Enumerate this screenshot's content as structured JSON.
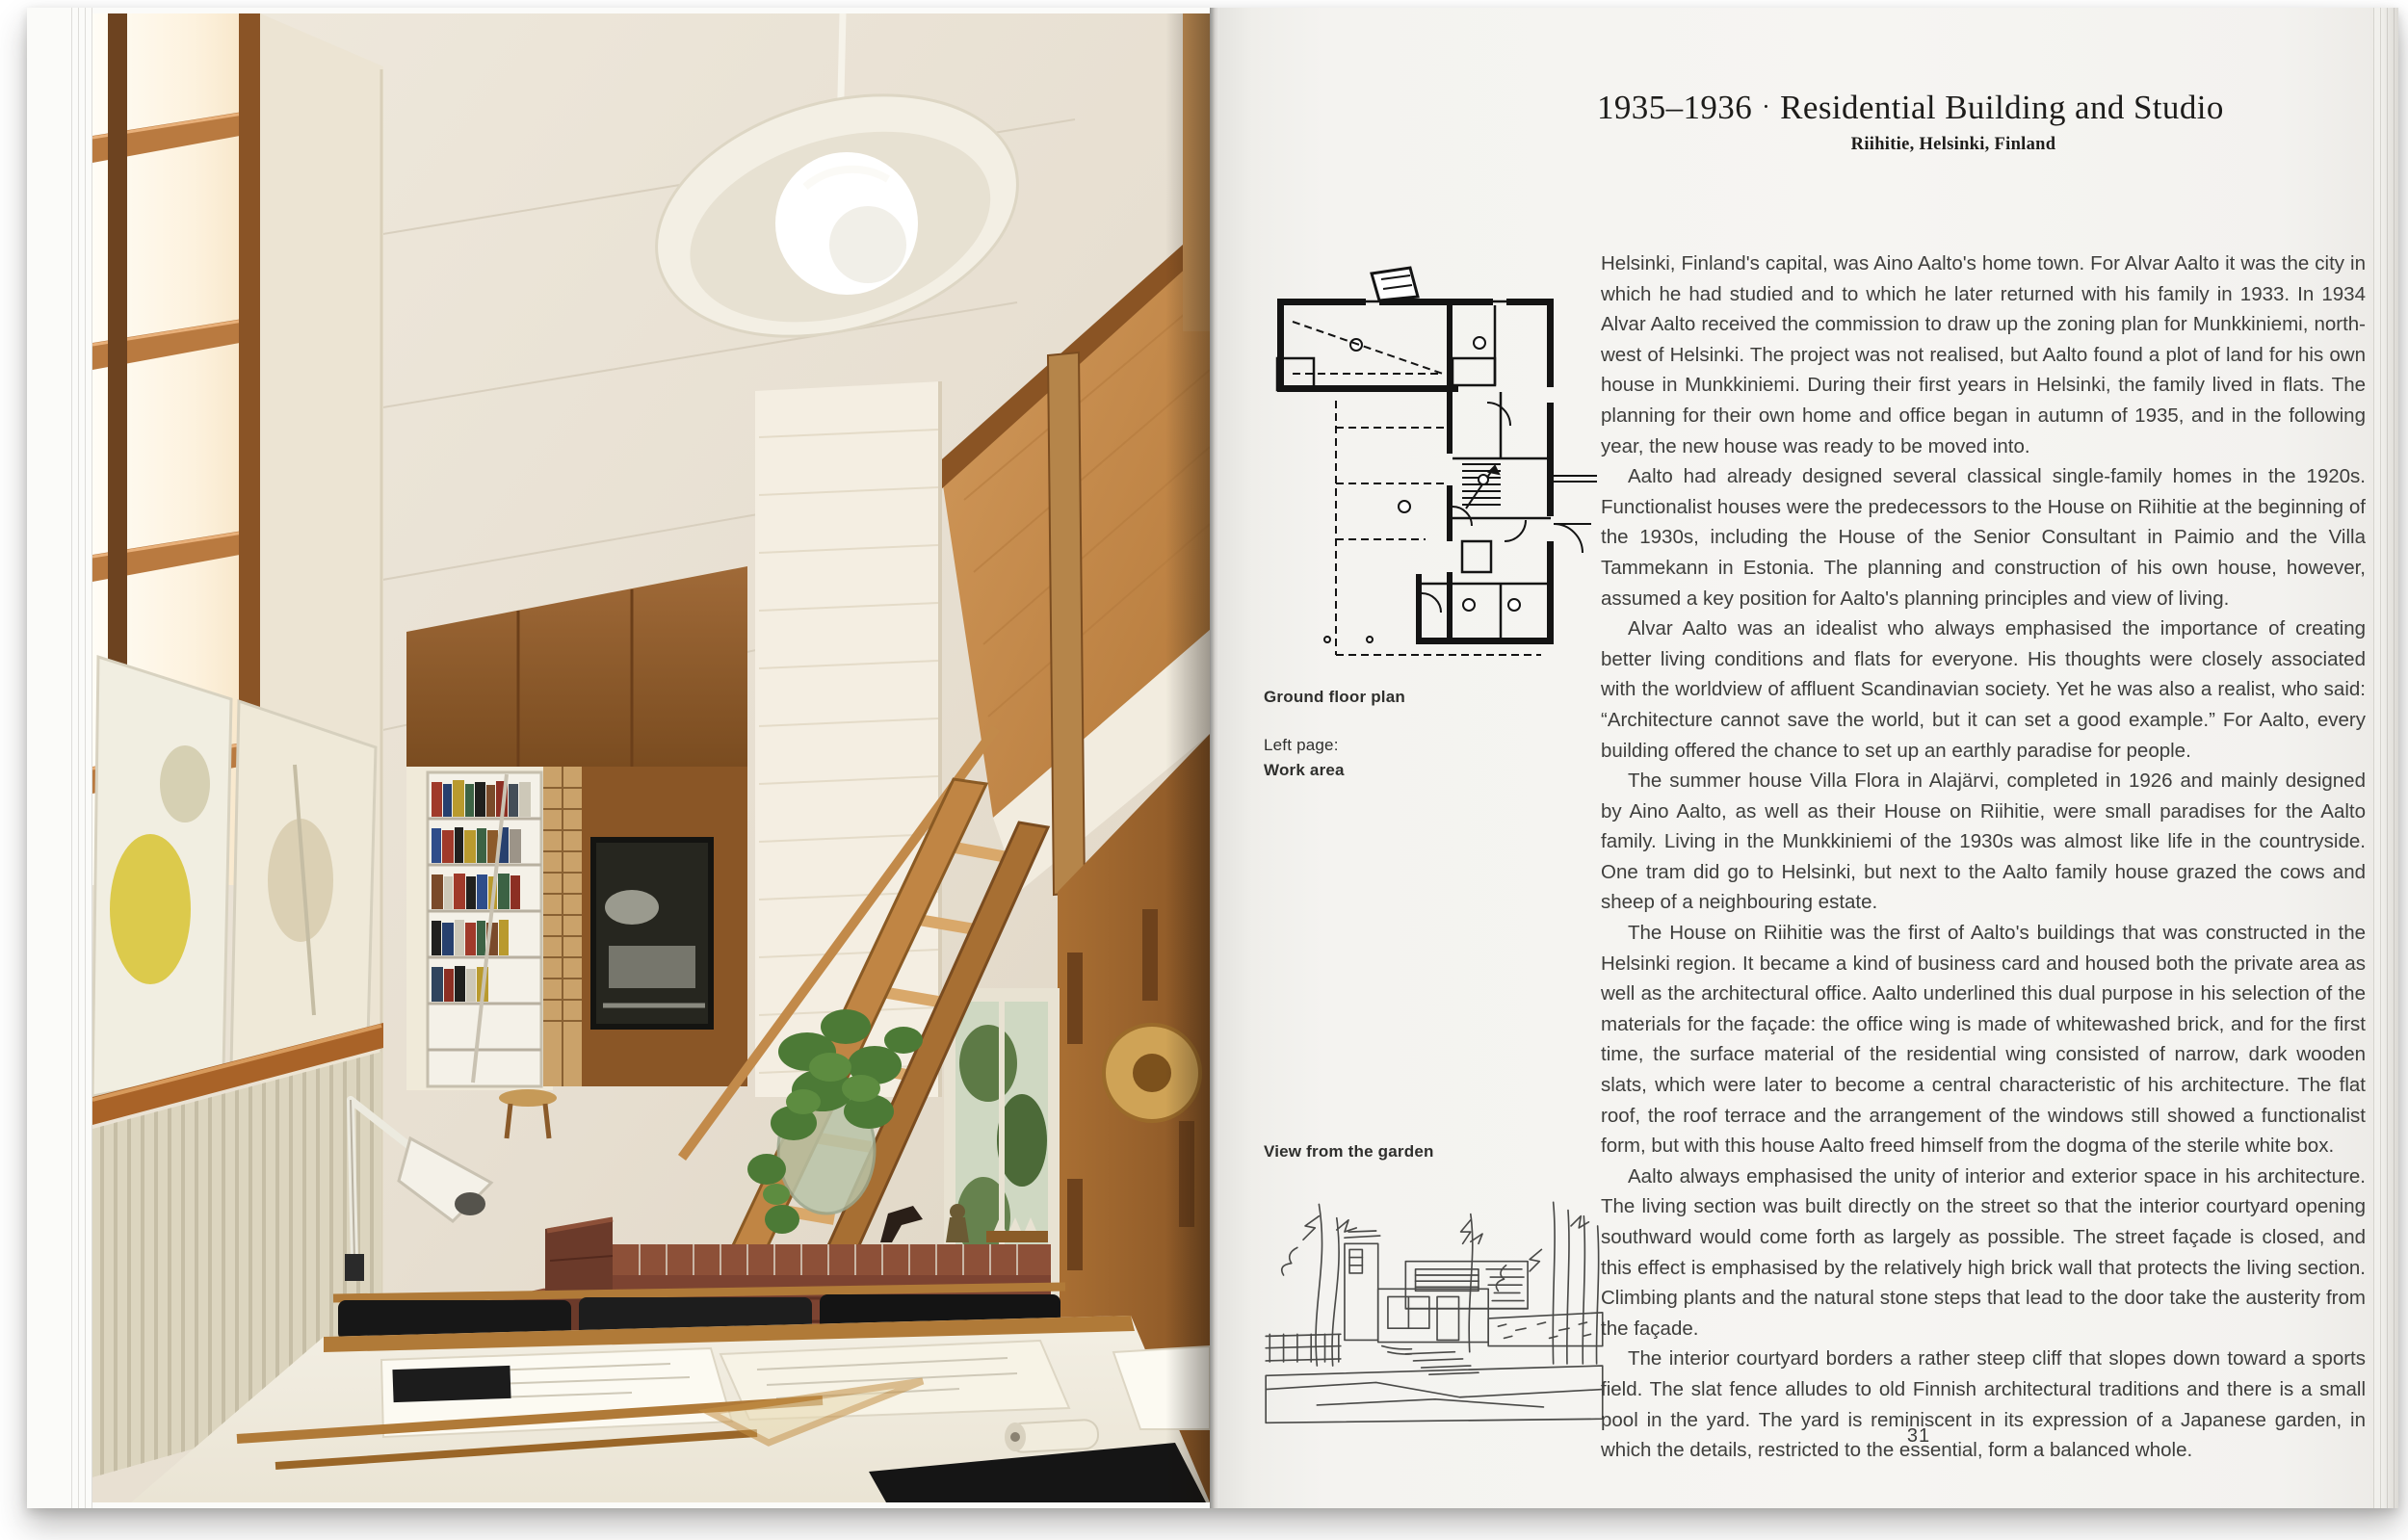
{
  "right_page": {
    "title": {
      "years": "1935–1936",
      "separator": "·",
      "name": "Residential Building and Studio",
      "location": "Riihitie, Helsinki, Finland"
    },
    "captions": {
      "ground_floor_plan": "Ground floor plan",
      "left_page_label": "Left page:",
      "left_page_caption": "Work area",
      "garden_view": "View from the garden"
    },
    "article": {
      "paragraphs": [
        "Helsinki, Finland's capital, was Aino Aalto's home town. For Alvar Aalto it was the city in which he had studied and to which he later returned with his family in 1933. In 1934 Alvar Aalto received the commission to draw up the zoning plan for Munkkiniemi, north-west of Helsinki. The project was not realised, but Aalto found a plot of land for his own house in Munkkiniemi. During their first years in Helsinki, the family lived in flats. The planning for their own home and office began in autumn of 1935, and in the following year, the new house was ready to be moved into.",
        "Aalto had already designed several classical single-family homes in the 1920s. Functionalist houses were the predecessors to the House on Riihitie at the beginning of the 1930s, including the House of the Senior Consultant in Paimio and the Villa Tammekann in Estonia. The planning and construction of his own house, however, assumed a key position for Aalto's planning principles and view of living.",
        "Alvar Aalto was an idealist who always emphasised the importance of creating better living conditions and flats for everyone. His thoughts were closely associated with the worldview of affluent Scandinavian society. Yet he was also a realist, who said: “Architecture cannot save the world, but it can set a good example.” For Aalto, every building offered the chance to set up an earthly paradise for people.",
        "The summer house Villa Flora in Alajärvi, completed in 1926 and mainly designed by Aino Aalto, as well as their House on Riihitie, were small paradises for the Aalto family. Living in the Munkkiniemi of the 1930s was almost like life in the countryside. One tram did go to Helsinki, but next to the Aalto family house grazed the cows and sheep of a neighbouring estate.",
        "The House on Riihitie was the first of Aalto's buildings that was constructed in the Helsinki region. It became a kind of business card and housed both the private area as well as the architectural office. Aalto underlined this dual purpose in his selection of the materials for the façade: the office wing is made of whitewashed brick, and for the first time, the surface material of the residential wing consisted of narrow, dark wooden slats, which were later to become a central characteristic of his architecture. The flat roof, the roof terrace and the arrangement of the windows still showed a functionalist form, but with this house Aalto freed himself from the dogma of the sterile white box.",
        "Aalto always emphasised the unity of interior and exterior space in his architecture. The living section was built directly on the street so that the interior courtyard opening southward would come forth as largely as possible. The street façade is closed, and this effect is emphasised by the relatively high brick wall that protects the living section. Climbing plants and the natural stone steps that lead to the door take the austerity from the façade.",
        "The interior courtyard borders a rather steep cliff that slopes down toward a sports field. The slat fence alludes to old Finnish architectural traditions and there is a small pool in the yard. The yard is reminiscent in its expression of a Japanese garden, in which the details, restricted to the essential, form a balanced whole."
      ]
    },
    "page_number": "31"
  },
  "left_page": {
    "description": "Work area photograph"
  },
  "colors": {
    "paper": "#f6f5f2",
    "body_text": "#3e3e3c",
    "title_text": "#1d1c1a",
    "wood": "#b5854a",
    "brick": "#7c4331",
    "weave": "#c08448",
    "plant": "#4c7a36"
  }
}
